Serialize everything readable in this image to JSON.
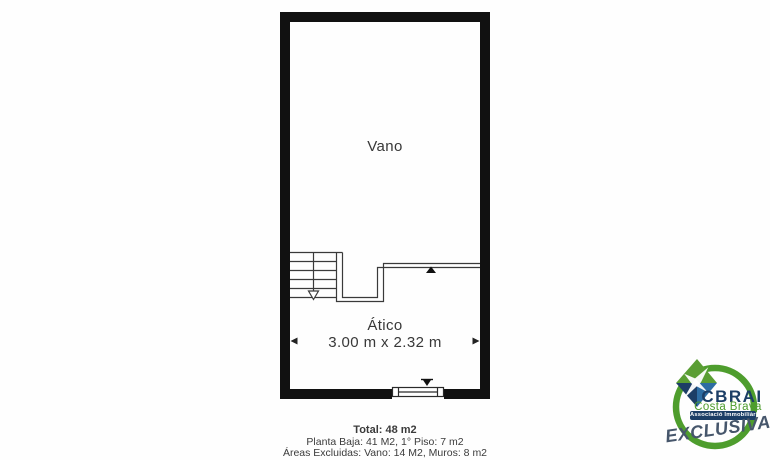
{
  "floor_plan": {
    "upper_room_label": "Vano",
    "lower_room_label": "Ático",
    "lower_room_dimensions": "3.00 m x 2.32 m"
  },
  "summary": {
    "total": "Total: 48 m2",
    "floors": "Planta Baja: 41 M2, 1° Piso: 7 m2",
    "excluded": "Áreas Excluidas: Vano: 14 M2, Muros: 8 m2"
  },
  "logo": {
    "brand": "CBRAI",
    "region": "Costa Brava",
    "association": "Associació Immobiliària",
    "tagline": "EXCLUSIVA"
  },
  "colors": {
    "wall": "#111111",
    "plan_line": "#3a3a3a",
    "text": "#383838",
    "logo_green": "#4e9d2d",
    "logo_navy": "#1c3e66",
    "logo_blue": "#2d6da3",
    "logo_slate": "#46566b"
  }
}
